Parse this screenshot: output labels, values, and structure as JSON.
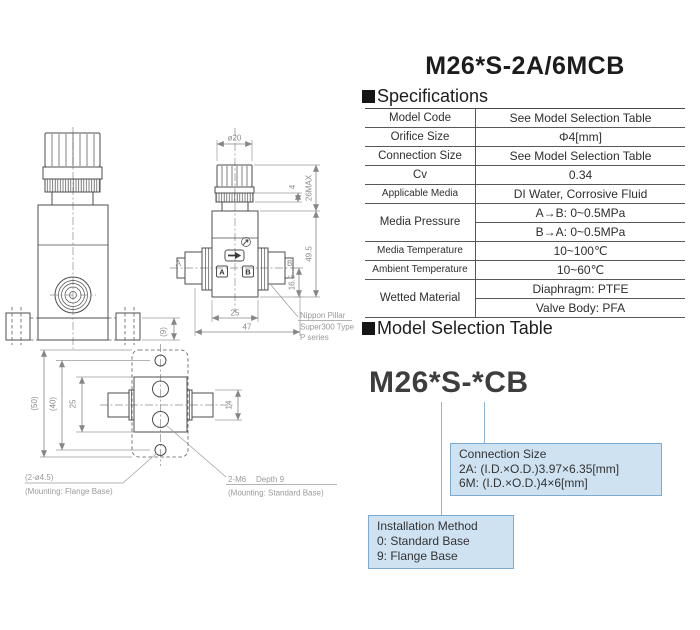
{
  "page": {
    "title": "M26*S-2A/6MCB"
  },
  "headings": {
    "specifications": "Specifications",
    "model_selection": "Model Selection Table"
  },
  "specs_table": {
    "rows": [
      {
        "label": "Model Code",
        "value": "See Model Selection Table"
      },
      {
        "label": "Orifice Size",
        "value": "Φ4[mm]"
      },
      {
        "label": "Connection Size",
        "value": "See Model Selection Table"
      },
      {
        "label": "Cv",
        "value": "0.34"
      },
      {
        "label": "Applicable Media",
        "value": "DI Water, Corrosive Fluid"
      },
      {
        "label": "Media Pressure",
        "value1": "A→B: 0~0.5MPa",
        "value2": "B→A: 0~0.5MPa"
      },
      {
        "label": "Media Temperature",
        "value": "10~100℃"
      },
      {
        "label": "Ambient Temperature",
        "value": "10~60℃"
      },
      {
        "label": "Wetted Material",
        "value1": "Diaphragm: PTFE",
        "value2": "Valve Body: PFA"
      }
    ]
  },
  "model_selection": {
    "model_code": "M26*S-*CB",
    "connection_box": {
      "title": "Connection Size",
      "line1": "2A: (I.D.×O.D.)3.97×6.35[mm]",
      "line2": "6M: (I.D.×O.D.)4×6[mm]"
    },
    "installation_box": {
      "title": "Installation Method",
      "line1": "0: Standard Base",
      "line2": "9: Flange Base"
    }
  },
  "drawing": {
    "d9": "(9)",
    "dia20": "ø20",
    "d4": "4",
    "d26max": "26MAX",
    "d495": "49.5",
    "d165": "16.5",
    "d25side": "25",
    "d47": "47",
    "portA": "A",
    "portB": "B",
    "boxA": "A",
    "boxB": "B",
    "pillar1": "Nippon Pillar",
    "pillar2": "Super300 Type",
    "pillar3": "P series",
    "d50": "(50)",
    "d40": "(40)",
    "d25bottom": "25",
    "d14": "14",
    "holeNote": "(2-ø4.5)",
    "holeMount": "(Mounting: Flange Base)",
    "m6Note": "2-M6",
    "m6Depth": "Depth 9",
    "m6Mount": "(Mounting: Standard Base)"
  },
  "colors": {
    "accent_fill": "#cfe2f2",
    "accent_border": "#7dabd0",
    "line": "#4d4d4d",
    "dim_text": "#8c8c8c"
  }
}
